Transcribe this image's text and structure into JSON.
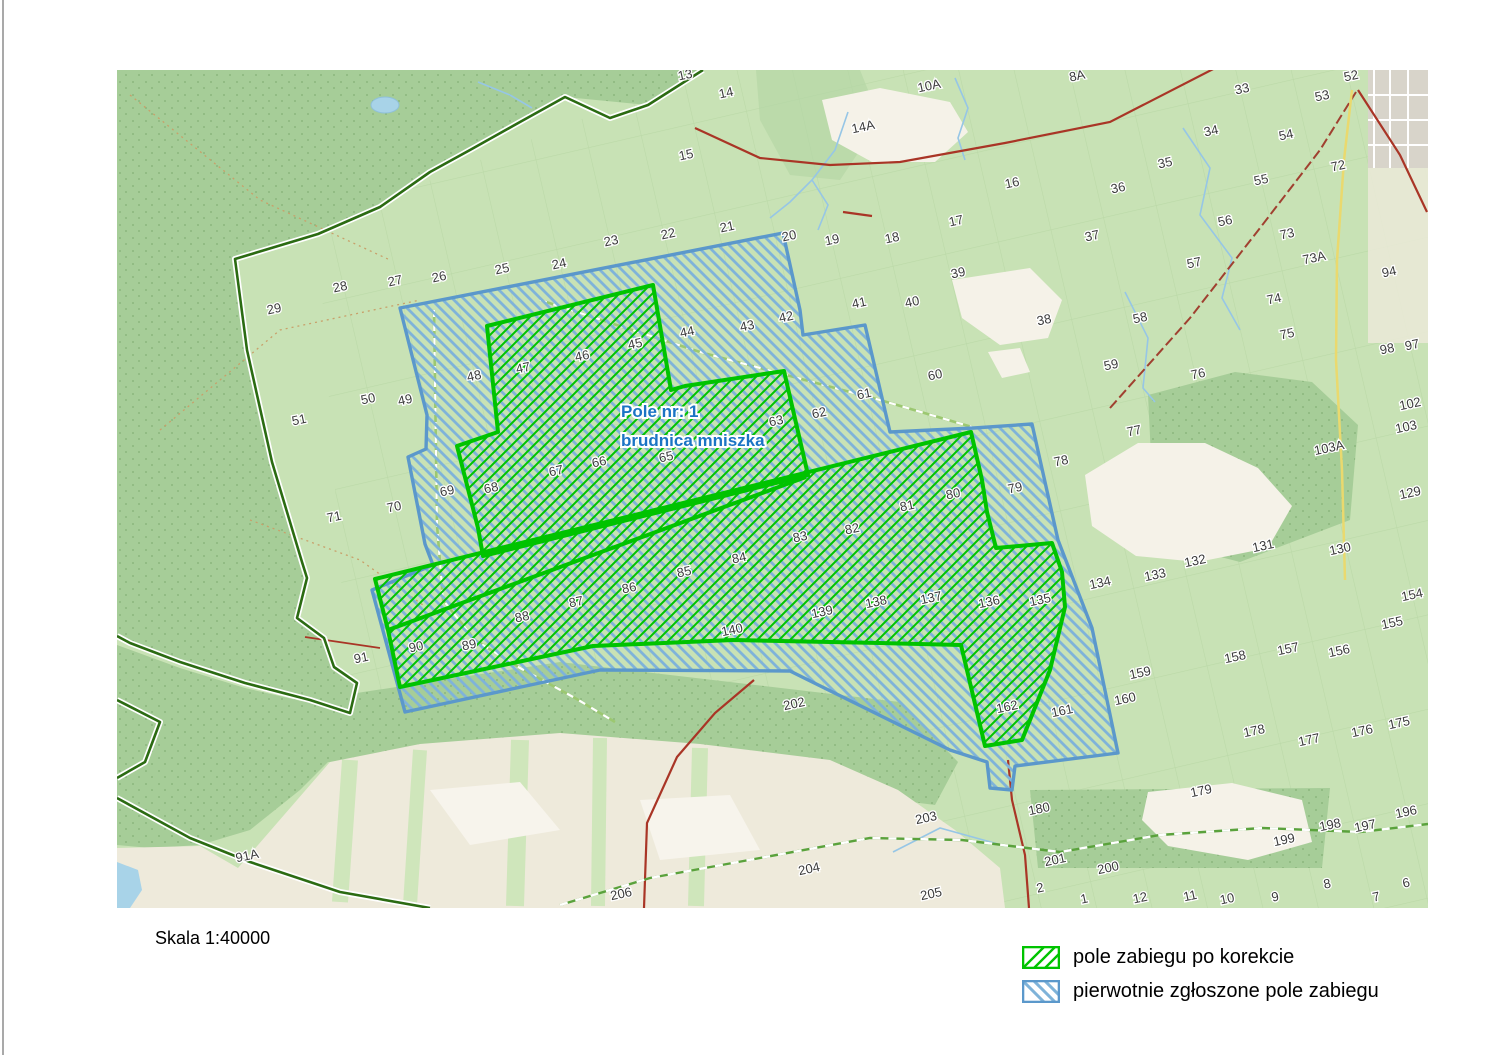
{
  "scale": {
    "label": "Skala 1:40000"
  },
  "legend": {
    "items": [
      {
        "key": "corrected",
        "label": "pole zabiegu po korekcie",
        "color": "#00c300",
        "hatch": "/"
      },
      {
        "key": "original",
        "label": "pierwotnie zgłoszone pole zabiegu",
        "color": "#5b98cb",
        "hatch": "\\"
      }
    ]
  },
  "map": {
    "field_label": {
      "line1": "Pole nr: 1",
      "line2": "brudnica mniszka",
      "x": 621,
      "y1": 417,
      "y2": 446,
      "color": "#1b74c4"
    },
    "colors": {
      "background_light_green": "#c8e2b5",
      "forest_green": "#a6cd98",
      "corrected_area_green": "#00c300",
      "original_area_blue": "#5b98cb",
      "original_hatch_blue": "#7fb3d9",
      "road_red": "#a93526",
      "stream_blue": "#96c6e6",
      "farmland_beige": "#eeeadb",
      "settlement_white": "#f5f2e8",
      "town_grey": "#d8d4ca"
    },
    "overlays": {
      "original_polygon": [
        [
          400,
          308
        ],
        [
          783,
          233
        ],
        [
          800,
          310
        ],
        [
          803,
          335
        ],
        [
          865,
          325
        ],
        [
          890,
          432
        ],
        [
          974,
          428
        ],
        [
          1032,
          424
        ],
        [
          1058,
          540
        ],
        [
          1092,
          628
        ],
        [
          1118,
          753
        ],
        [
          1015,
          766
        ],
        [
          1012,
          790
        ],
        [
          990,
          788
        ],
        [
          987,
          762
        ],
        [
          950,
          750
        ],
        [
          790,
          671
        ],
        [
          600,
          670
        ],
        [
          405,
          712
        ],
        [
          372,
          590
        ],
        [
          433,
          565
        ],
        [
          425,
          544
        ],
        [
          408,
          457
        ],
        [
          426,
          449
        ],
        [
          427,
          415
        ]
      ],
      "corrected_polygon_upper": [
        [
          487,
          326
        ],
        [
          653,
          285
        ],
        [
          671,
          390
        ],
        [
          685,
          386
        ],
        [
          784,
          371
        ],
        [
          808,
          475
        ],
        [
          483,
          556
        ],
        [
          478,
          528
        ],
        [
          457,
          446
        ],
        [
          498,
          432
        ]
      ],
      "corrected_polygon_lower": [
        [
          375,
          579
        ],
        [
          971,
          432
        ],
        [
          982,
          480
        ],
        [
          987,
          512
        ],
        [
          996,
          548
        ],
        [
          1052,
          543
        ],
        [
          1062,
          572
        ],
        [
          1065,
          607
        ],
        [
          1050,
          670
        ],
        [
          1022,
          740
        ],
        [
          985,
          746
        ],
        [
          961,
          645
        ],
        [
          880,
          643
        ],
        [
          733,
          640
        ],
        [
          593,
          646
        ],
        [
          400,
          687
        ],
        [
          388,
          630
        ]
      ],
      "corrected_inner_edge": [
        [
          388,
          630
        ],
        [
          806,
          477
        ]
      ]
    },
    "compartment_labels": [
      {
        "t": "13",
        "x": 686,
        "y": 79
      },
      {
        "t": "14",
        "x": 727,
        "y": 97
      },
      {
        "t": "14A",
        "x": 864,
        "y": 131
      },
      {
        "t": "10A",
        "x": 930,
        "y": 90
      },
      {
        "t": "8A",
        "x": 1078,
        "y": 80
      },
      {
        "t": "52",
        "x": 1352,
        "y": 80
      },
      {
        "t": "53",
        "x": 1323,
        "y": 100
      },
      {
        "t": "33",
        "x": 1243,
        "y": 93
      },
      {
        "t": "34",
        "x": 1212,
        "y": 135
      },
      {
        "t": "54",
        "x": 1287,
        "y": 139
      },
      {
        "t": "15",
        "x": 687,
        "y": 159
      },
      {
        "t": "16",
        "x": 1013,
        "y": 187
      },
      {
        "t": "35",
        "x": 1166,
        "y": 167
      },
      {
        "t": "36",
        "x": 1119,
        "y": 192
      },
      {
        "t": "55",
        "x": 1262,
        "y": 184
      },
      {
        "t": "72",
        "x": 1339,
        "y": 170
      },
      {
        "t": "17",
        "x": 957,
        "y": 225
      },
      {
        "t": "18",
        "x": 893,
        "y": 242
      },
      {
        "t": "19",
        "x": 833,
        "y": 244
      },
      {
        "t": "37",
        "x": 1093,
        "y": 240
      },
      {
        "t": "56",
        "x": 1226,
        "y": 225
      },
      {
        "t": "57",
        "x": 1195,
        "y": 267
      },
      {
        "t": "73",
        "x": 1288,
        "y": 238
      },
      {
        "t": "73A",
        "x": 1315,
        "y": 262
      },
      {
        "t": "94",
        "x": 1390,
        "y": 276
      },
      {
        "t": "20",
        "x": 790,
        "y": 240
      },
      {
        "t": "21",
        "x": 728,
        "y": 231
      },
      {
        "t": "22",
        "x": 669,
        "y": 238
      },
      {
        "t": "23",
        "x": 612,
        "y": 245
      },
      {
        "t": "24",
        "x": 560,
        "y": 268
      },
      {
        "t": "25",
        "x": 503,
        "y": 273
      },
      {
        "t": "26",
        "x": 440,
        "y": 281
      },
      {
        "t": "27",
        "x": 396,
        "y": 285
      },
      {
        "t": "28",
        "x": 341,
        "y": 291
      },
      {
        "t": "29",
        "x": 275,
        "y": 313
      },
      {
        "t": "39",
        "x": 959,
        "y": 277
      },
      {
        "t": "40",
        "x": 913,
        "y": 306
      },
      {
        "t": "41",
        "x": 860,
        "y": 307
      },
      {
        "t": "38",
        "x": 1045,
        "y": 324
      },
      {
        "t": "58",
        "x": 1141,
        "y": 322
      },
      {
        "t": "74",
        "x": 1275,
        "y": 303
      },
      {
        "t": "75",
        "x": 1288,
        "y": 338
      },
      {
        "t": "97",
        "x": 1413,
        "y": 349
      },
      {
        "t": "98",
        "x": 1388,
        "y": 353
      },
      {
        "t": "42",
        "x": 787,
        "y": 321
      },
      {
        "t": "43",
        "x": 748,
        "y": 330
      },
      {
        "t": "44",
        "x": 688,
        "y": 336
      },
      {
        "t": "45",
        "x": 636,
        "y": 348
      },
      {
        "t": "46",
        "x": 583,
        "y": 360
      },
      {
        "t": "47",
        "x": 524,
        "y": 372
      },
      {
        "t": "48",
        "x": 475,
        "y": 380
      },
      {
        "t": "49",
        "x": 406,
        "y": 404
      },
      {
        "t": "50",
        "x": 369,
        "y": 403
      },
      {
        "t": "51",
        "x": 300,
        "y": 424
      },
      {
        "t": "60",
        "x": 936,
        "y": 379
      },
      {
        "t": "61",
        "x": 865,
        "y": 398
      },
      {
        "t": "62",
        "x": 820,
        "y": 417
      },
      {
        "t": "63",
        "x": 777,
        "y": 425
      },
      {
        "t": "59",
        "x": 1112,
        "y": 369
      },
      {
        "t": "76",
        "x": 1199,
        "y": 378
      },
      {
        "t": "102",
        "x": 1411,
        "y": 408
      },
      {
        "t": "103",
        "x": 1407,
        "y": 431
      },
      {
        "t": "65",
        "x": 667,
        "y": 461
      },
      {
        "t": "66",
        "x": 600,
        "y": 466
      },
      {
        "t": "67",
        "x": 557,
        "y": 475
      },
      {
        "t": "68",
        "x": 492,
        "y": 492
      },
      {
        "t": "69",
        "x": 448,
        "y": 495
      },
      {
        "t": "70",
        "x": 395,
        "y": 511
      },
      {
        "t": "71",
        "x": 335,
        "y": 521
      },
      {
        "t": "77",
        "x": 1135,
        "y": 435
      },
      {
        "t": "78",
        "x": 1062,
        "y": 465
      },
      {
        "t": "103A",
        "x": 1330,
        "y": 452
      },
      {
        "t": "79",
        "x": 1016,
        "y": 492
      },
      {
        "t": "80",
        "x": 954,
        "y": 498
      },
      {
        "t": "81",
        "x": 908,
        "y": 510
      },
      {
        "t": "129",
        "x": 1411,
        "y": 497
      },
      {
        "t": "82",
        "x": 853,
        "y": 533
      },
      {
        "t": "83",
        "x": 801,
        "y": 541
      },
      {
        "t": "84",
        "x": 740,
        "y": 562
      },
      {
        "t": "85",
        "x": 685,
        "y": 576
      },
      {
        "t": "86",
        "x": 630,
        "y": 592
      },
      {
        "t": "87",
        "x": 577,
        "y": 606
      },
      {
        "t": "88",
        "x": 523,
        "y": 621
      },
      {
        "t": "89",
        "x": 470,
        "y": 649
      },
      {
        "t": "90",
        "x": 417,
        "y": 651
      },
      {
        "t": "91",
        "x": 362,
        "y": 662
      },
      {
        "t": "131",
        "x": 1264,
        "y": 550
      },
      {
        "t": "130",
        "x": 1341,
        "y": 553
      },
      {
        "t": "132",
        "x": 1196,
        "y": 565
      },
      {
        "t": "133",
        "x": 1156,
        "y": 579
      },
      {
        "t": "134",
        "x": 1101,
        "y": 587
      },
      {
        "t": "135",
        "x": 1041,
        "y": 604
      },
      {
        "t": "136",
        "x": 990,
        "y": 606
      },
      {
        "t": "137",
        "x": 932,
        "y": 602
      },
      {
        "t": "138",
        "x": 877,
        "y": 606
      },
      {
        "t": "139",
        "x": 823,
        "y": 616
      },
      {
        "t": "140",
        "x": 733,
        "y": 634
      },
      {
        "t": "154",
        "x": 1413,
        "y": 599
      },
      {
        "t": "155",
        "x": 1393,
        "y": 627
      },
      {
        "t": "156",
        "x": 1340,
        "y": 655
      },
      {
        "t": "157",
        "x": 1289,
        "y": 653
      },
      {
        "t": "158",
        "x": 1236,
        "y": 661
      },
      {
        "t": "159",
        "x": 1141,
        "y": 677
      },
      {
        "t": "160",
        "x": 1126,
        "y": 703
      },
      {
        "t": "161",
        "x": 1063,
        "y": 715
      },
      {
        "t": "162",
        "x": 1008,
        "y": 711
      },
      {
        "t": "175",
        "x": 1400,
        "y": 727
      },
      {
        "t": "176",
        "x": 1363,
        "y": 735
      },
      {
        "t": "177",
        "x": 1310,
        "y": 744
      },
      {
        "t": "178",
        "x": 1255,
        "y": 735
      },
      {
        "t": "179",
        "x": 1202,
        "y": 795
      },
      {
        "t": "202",
        "x": 795,
        "y": 708
      },
      {
        "t": "180",
        "x": 1040,
        "y": 813
      },
      {
        "t": "203",
        "x": 927,
        "y": 822
      },
      {
        "t": "198",
        "x": 1331,
        "y": 829
      },
      {
        "t": "197",
        "x": 1366,
        "y": 830
      },
      {
        "t": "196",
        "x": 1407,
        "y": 816
      },
      {
        "t": "199",
        "x": 1285,
        "y": 844
      },
      {
        "t": "204",
        "x": 810,
        "y": 873
      },
      {
        "t": "205",
        "x": 932,
        "y": 898
      },
      {
        "t": "206",
        "x": 622,
        "y": 898
      },
      {
        "t": "200",
        "x": 1109,
        "y": 872
      },
      {
        "t": "201",
        "x": 1056,
        "y": 864
      },
      {
        "t": "91A",
        "x": 248,
        "y": 860
      },
      {
        "t": "2",
        "x": 1041,
        "y": 892
      },
      {
        "t": "1",
        "x": 1085,
        "y": 903
      },
      {
        "t": "12",
        "x": 1141,
        "y": 902
      },
      {
        "t": "11",
        "x": 1191,
        "y": 900
      },
      {
        "t": "10",
        "x": 1228,
        "y": 903
      },
      {
        "t": "9",
        "x": 1276,
        "y": 901
      },
      {
        "t": "8",
        "x": 1328,
        "y": 888
      },
      {
        "t": "7",
        "x": 1377,
        "y": 901
      },
      {
        "t": "6",
        "x": 1407,
        "y": 887
      }
    ]
  }
}
